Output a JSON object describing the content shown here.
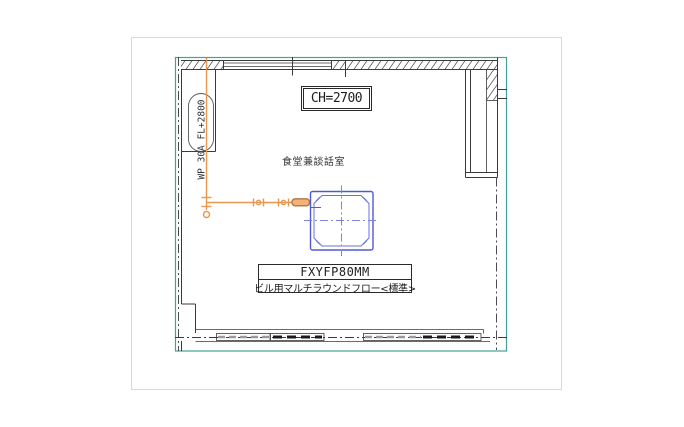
{
  "drawing": {
    "ceiling_height_label": "CH=2700",
    "room_name": "食堂兼談話室",
    "pipe_riser_label": "WP 30A FL+2800",
    "unit_model": "FXYFP80MM",
    "unit_description": "ビル用マルチラウンドフロー<標準>"
  },
  "colors": {
    "frame_teal": "#44a09a",
    "pipe_orange": "#e8984f",
    "pipe_fitting_orange": "#b4763c",
    "unit_blue": "#5158d6",
    "unit_blue_light": "#7b84e4",
    "wall_line": "#3a3a3a"
  }
}
